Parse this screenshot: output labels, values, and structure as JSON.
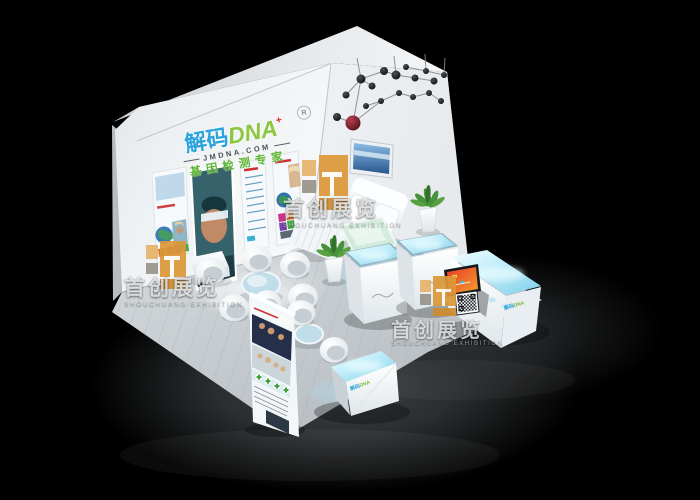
{
  "brand": {
    "name_cn": "解码",
    "name_en": "DNA",
    "plus_mark": "+",
    "reg_mark": "R",
    "domain": "JMDNA.COM",
    "tagline": "基因检测专家",
    "colors": {
      "name_cn": "#2ba3dc",
      "name_en": "#8dc63f",
      "plus": "#e02525",
      "tagline": "#5cb531"
    }
  },
  "watermark": {
    "text_cn": "首创展览",
    "text_en": "SHOUCHUANG EXHIBITION",
    "logo_orange": "#dc9838",
    "logo_tan": "#e7b36b",
    "logo_gray": "#98948a",
    "instances": [
      "left",
      "top-center",
      "bottom-right"
    ]
  },
  "scene_colors": {
    "background": "#000000",
    "wall_white": "#f4f6f8",
    "floor_gray": "#ccd1d5",
    "counter_glow_cyan": "#a8e2f4",
    "chandelier_accent_red": "#b84050",
    "sofa_white": "#f6f8f9",
    "coffee_table_glass": "#d2ecdc",
    "meeting_table_glass": "#bfdeea"
  }
}
